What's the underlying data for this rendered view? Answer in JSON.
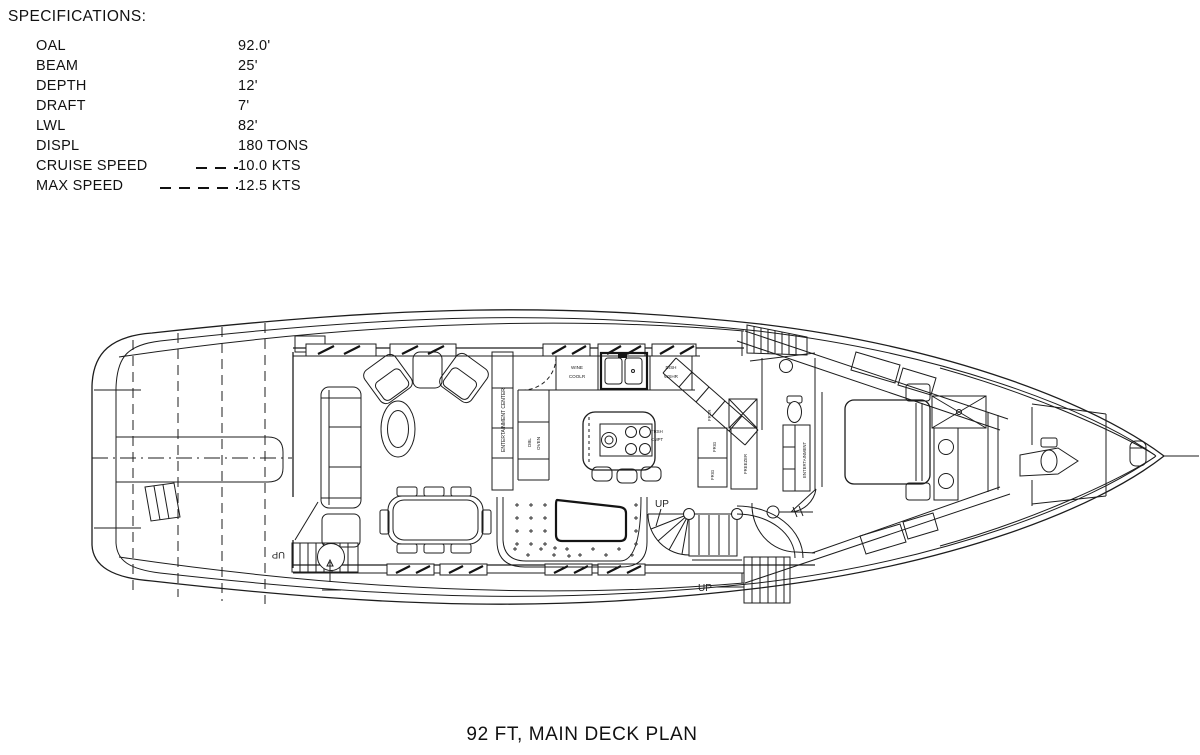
{
  "specifications": {
    "heading": "SPECIFICATIONS:",
    "rows": [
      {
        "label": "OAL",
        "value": "92.0'"
      },
      {
        "label": "BEAM",
        "value": "25'"
      },
      {
        "label": "DEPTH",
        "value": "12'"
      },
      {
        "label": "DRAFT",
        "value": "7'"
      },
      {
        "label": "LWL",
        "value": "82'"
      },
      {
        "label": "DISPL",
        "value": "180 TONS"
      },
      {
        "label": "CRUISE SPEED",
        "value": "10.0 KTS"
      },
      {
        "label": "MAX SPEED",
        "value": "12.5 KTS"
      }
    ]
  },
  "plan": {
    "labels": {
      "entertainment_center": "ENTERTAINMENT CENTER",
      "wine_cooler_1": "WINE",
      "wine_cooler_2": "COOLR",
      "dishwasher_1": "DISH",
      "dishwasher_2": "WSHR",
      "double_oven_1": "DBL",
      "double_oven_2": "OVEN",
      "trash_compactor_1": "TRSH",
      "trash_compactor_2": "CMPT",
      "freezer_abbr": "FRZR",
      "fridge_1": "FRIG",
      "fridge_2": "FRIG",
      "freezer": "FREEZER",
      "entertainment": "ENTERTAINMENT",
      "up_aft_stairs": "UP",
      "up_center_stairs": "UP",
      "up_side_deck": "UP"
    }
  },
  "title": "92 FT, MAIN DECK PLAN"
}
